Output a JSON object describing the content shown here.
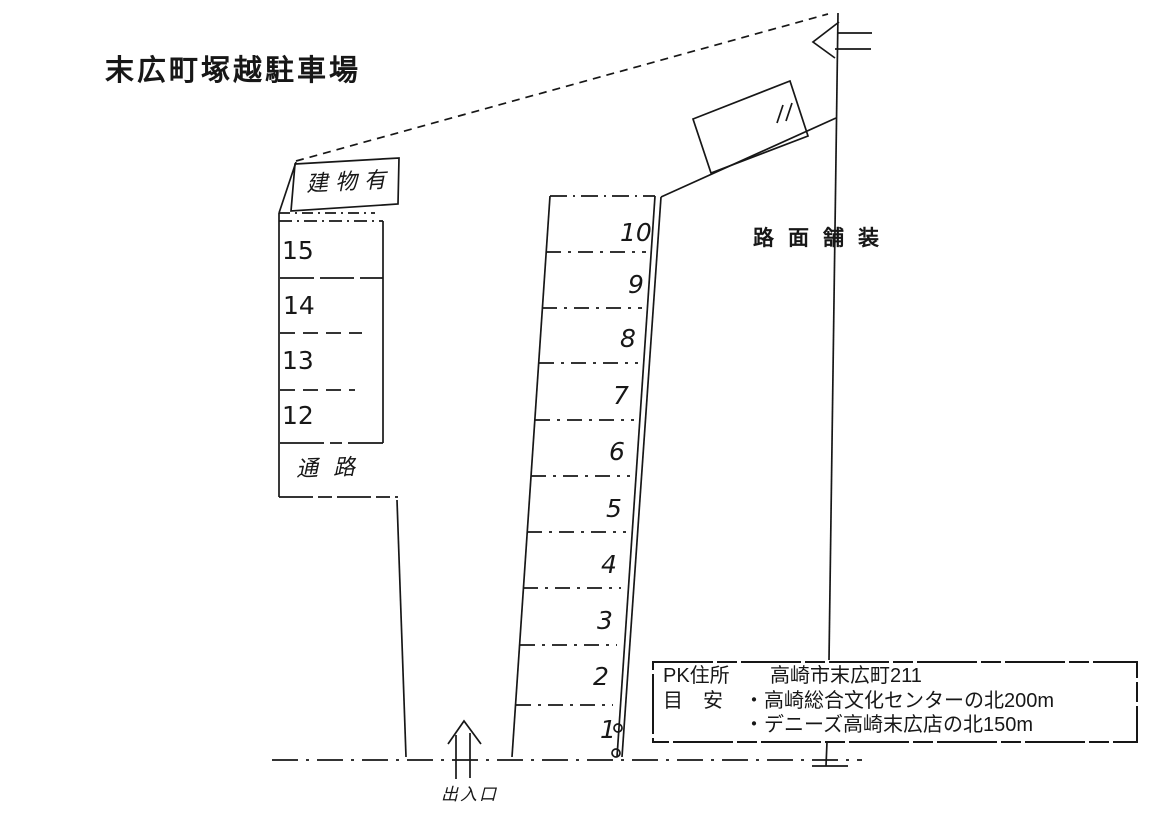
{
  "title": "末広町塚越駐車場",
  "building": {
    "label": "建物有"
  },
  "labels": {
    "aisle": "通路",
    "pavement": "路面舗装",
    "entrance": "出入口"
  },
  "left_block": {
    "spaces": [
      "15",
      "14",
      "13",
      "12"
    ]
  },
  "middle_column": {
    "spaces": [
      "10",
      "9",
      "8",
      "7",
      "6",
      "5",
      "4",
      "3",
      "2",
      "1"
    ]
  },
  "info_box": {
    "rows": [
      {
        "key": "PK住所",
        "value": "高崎市末広町211"
      },
      {
        "key": "目　安",
        "value": "・高崎総合文化センターの北200m"
      },
      {
        "key": "",
        "value": "・デニーズ高崎末広店の北150m"
      }
    ]
  },
  "colors": {
    "ink": "#171717",
    "paper": "#ffffff"
  }
}
